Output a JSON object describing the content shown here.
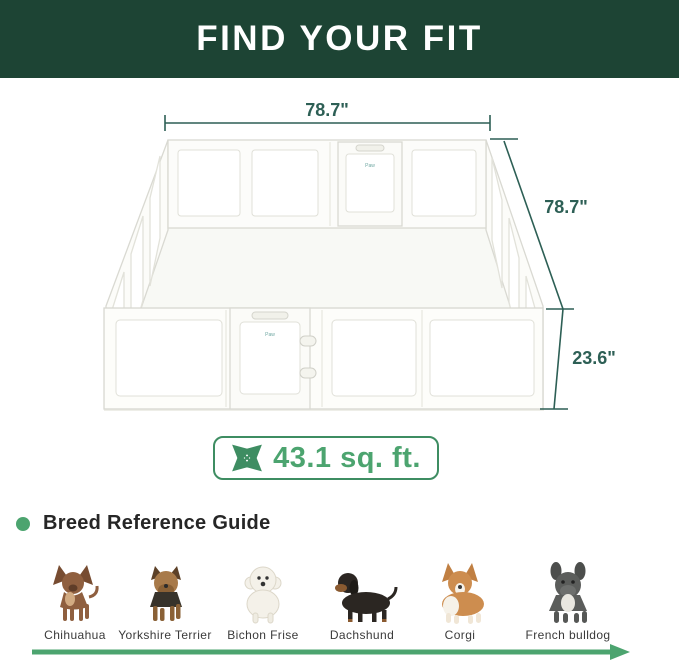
{
  "header": {
    "title": "FIND YOUR FIT"
  },
  "diagram": {
    "width_label": "78.7\"",
    "depth_label": "78.7\"",
    "height_label": "23.6\"",
    "door_logo": "Paw",
    "area_badge": {
      "icon": "expand-arrows-icon",
      "text": "43.1 sq. ft."
    }
  },
  "breed_guide": {
    "title": "Breed Reference Guide",
    "bullet_icon": "green-dot",
    "arrow_icon": "right-arrow-icon",
    "breeds": [
      {
        "name": "Chihuahua"
      },
      {
        "name": "Yorkshire Terrier"
      },
      {
        "name": "Bichon Frise"
      },
      {
        "name": "Dachshund"
      },
      {
        "name": "Corgi"
      },
      {
        "name": "French bulldog"
      }
    ]
  },
  "colors": {
    "banner_green": "#1d4434",
    "dimension_teal": "#2d5f55",
    "accent_green": "#4ca46f",
    "badge_border_green": "#3e8d62"
  }
}
